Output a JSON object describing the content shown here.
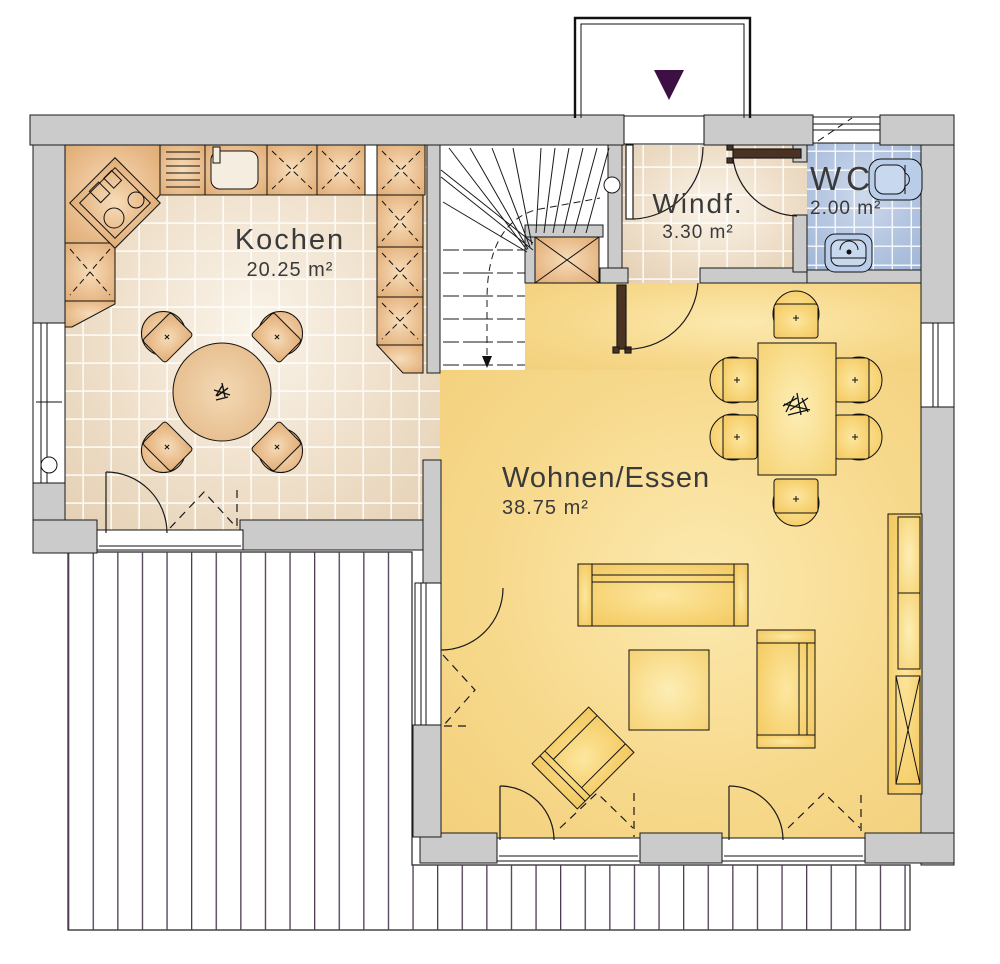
{
  "rooms": {
    "kitchen": {
      "name": "Kochen",
      "area": "20.25 m²"
    },
    "vestibule": {
      "name": "Windf.",
      "area": "3.30 m²"
    },
    "wc": {
      "name": "WC",
      "area": "2.00 m²"
    },
    "living_dining": {
      "name": "Wohnen/Essen",
      "area": "38.75 m²"
    }
  },
  "colors": {
    "wall_fill": "#cbcbcb",
    "kitchen_floor": "#eedec8",
    "vestibule_floor": "#eedec8",
    "wc_floor": "#b0c2de",
    "living_floor": "#f7d98c",
    "kitchen_furniture": "#e9bc8c",
    "living_furniture": "#f7d272",
    "door_leaf": "#4a3322",
    "entrance_arrow": "#3c1043",
    "terrace_plank_line": "#4e3a52"
  },
  "icons": {
    "entrance_arrow": "triangle-down"
  }
}
